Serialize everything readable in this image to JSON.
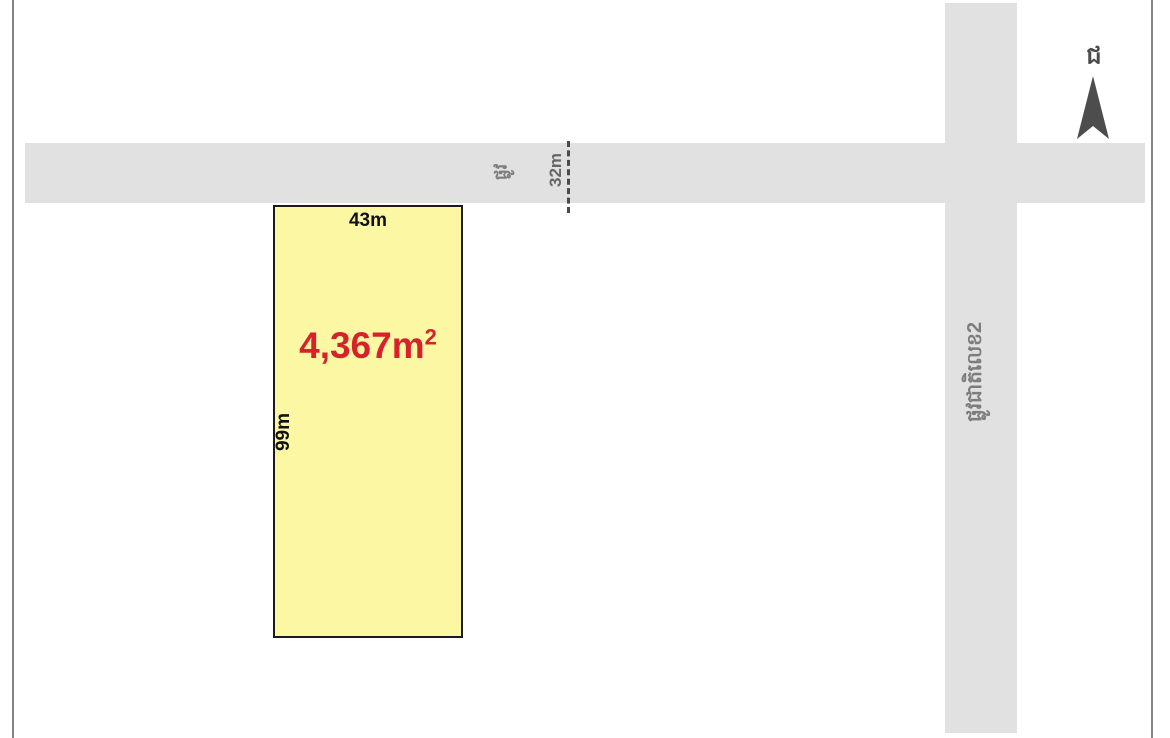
{
  "diagram": {
    "kind": "land-plot-sketch-map",
    "background_color": "#ffffff",
    "frame_color": "#848484"
  },
  "plot": {
    "area_value": "4,367m",
    "area_sup": "2",
    "top_width_label": "43m",
    "left_height_label": "99m",
    "fill_color": "#fbf7a3",
    "border_color": "#1b1b1b",
    "area_text_color": "#d6222a",
    "dimension_text_color": "#111111"
  },
  "roads": {
    "fill_color": "#e1e1e1",
    "label_color": "#7d7d7d",
    "horizontal_road": {
      "name_khmer": "ផ្លូវ",
      "width_label": "32m"
    },
    "vertical_road": {
      "name_khmer": "ផ្លូវជាតិលេខ2"
    }
  },
  "compass": {
    "north_letter_khmer": "ជ",
    "arrow_color": "#4d4d4d"
  }
}
